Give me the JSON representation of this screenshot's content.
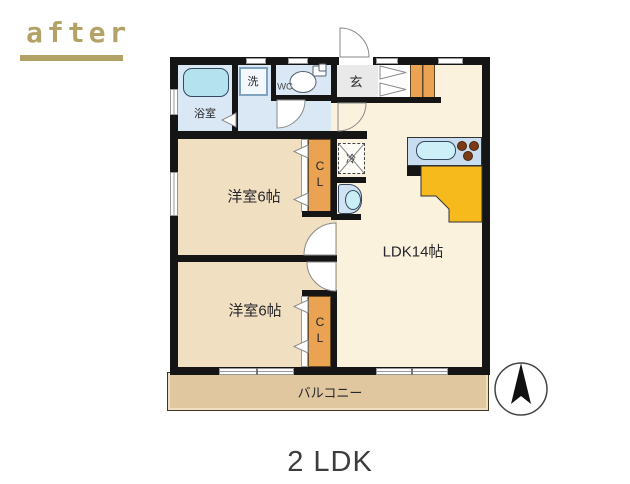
{
  "header": {
    "after_label": "after"
  },
  "caption": {
    "text": "2 LDK"
  },
  "plan": {
    "bathroom_label": "浴室",
    "washer_label": "洗",
    "wc_label": "WC",
    "entrance_label": "玄",
    "fridge_label": "冷",
    "closet_label_1": "CL",
    "closet_label_2": "CL",
    "bedroom1_label": "洋室6帖",
    "bedroom2_label": "洋室6帖",
    "ldk_label": "LDK14帖",
    "balcony_label": "バルコニー"
  },
  "colors": {
    "accent_gold": "#b3a266",
    "wall_black": "#151515",
    "room_tan": "#f1dfc1",
    "ldk_cream": "#fbf2dd",
    "water_blue": "#d9e8f4",
    "closet_orange": "#e9a352",
    "counter_yellow": "#f6ba1c",
    "balcony_tan": "#e1c79f",
    "caption_gray": "#3c3c3c"
  }
}
